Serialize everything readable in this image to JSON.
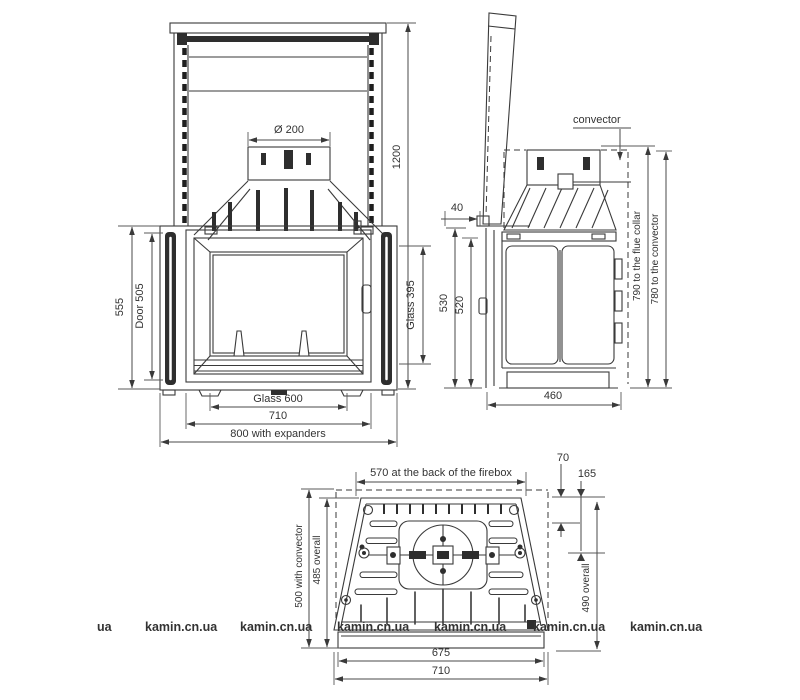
{
  "views": {
    "front": {
      "flue_diameter": "Ø 200",
      "total_height": "1200",
      "height": "555",
      "door_height": "Door 505",
      "glass_height": "Glass 395",
      "glass_width": "Glass 600",
      "body_width": "710",
      "width_with_expanders": "800 with expanders"
    },
    "side": {
      "convector_label": "convector",
      "door_gap": "40",
      "height_outer": "530",
      "height_inner": "520",
      "depth": "460",
      "flue_collar_height": "790 to the flue collar",
      "convector_height": "780 to the convector"
    },
    "bottom": {
      "back_width": "570 at the back of the firebox",
      "flue_offset_back": "70",
      "flue_offset_center": "165",
      "depth_with_convector": "500 with convector",
      "depth_overall": "485 overall",
      "depth_overall_right": "490 overall",
      "base_width": "675",
      "front_width": "710"
    }
  },
  "watermark": {
    "text": "kamin.cn.ua",
    "partial_text": "ua",
    "color": "#9b9b9b"
  },
  "colors": {
    "line": "#3a3a3a",
    "dimension_text": "#333333",
    "background": "#ffffff"
  }
}
